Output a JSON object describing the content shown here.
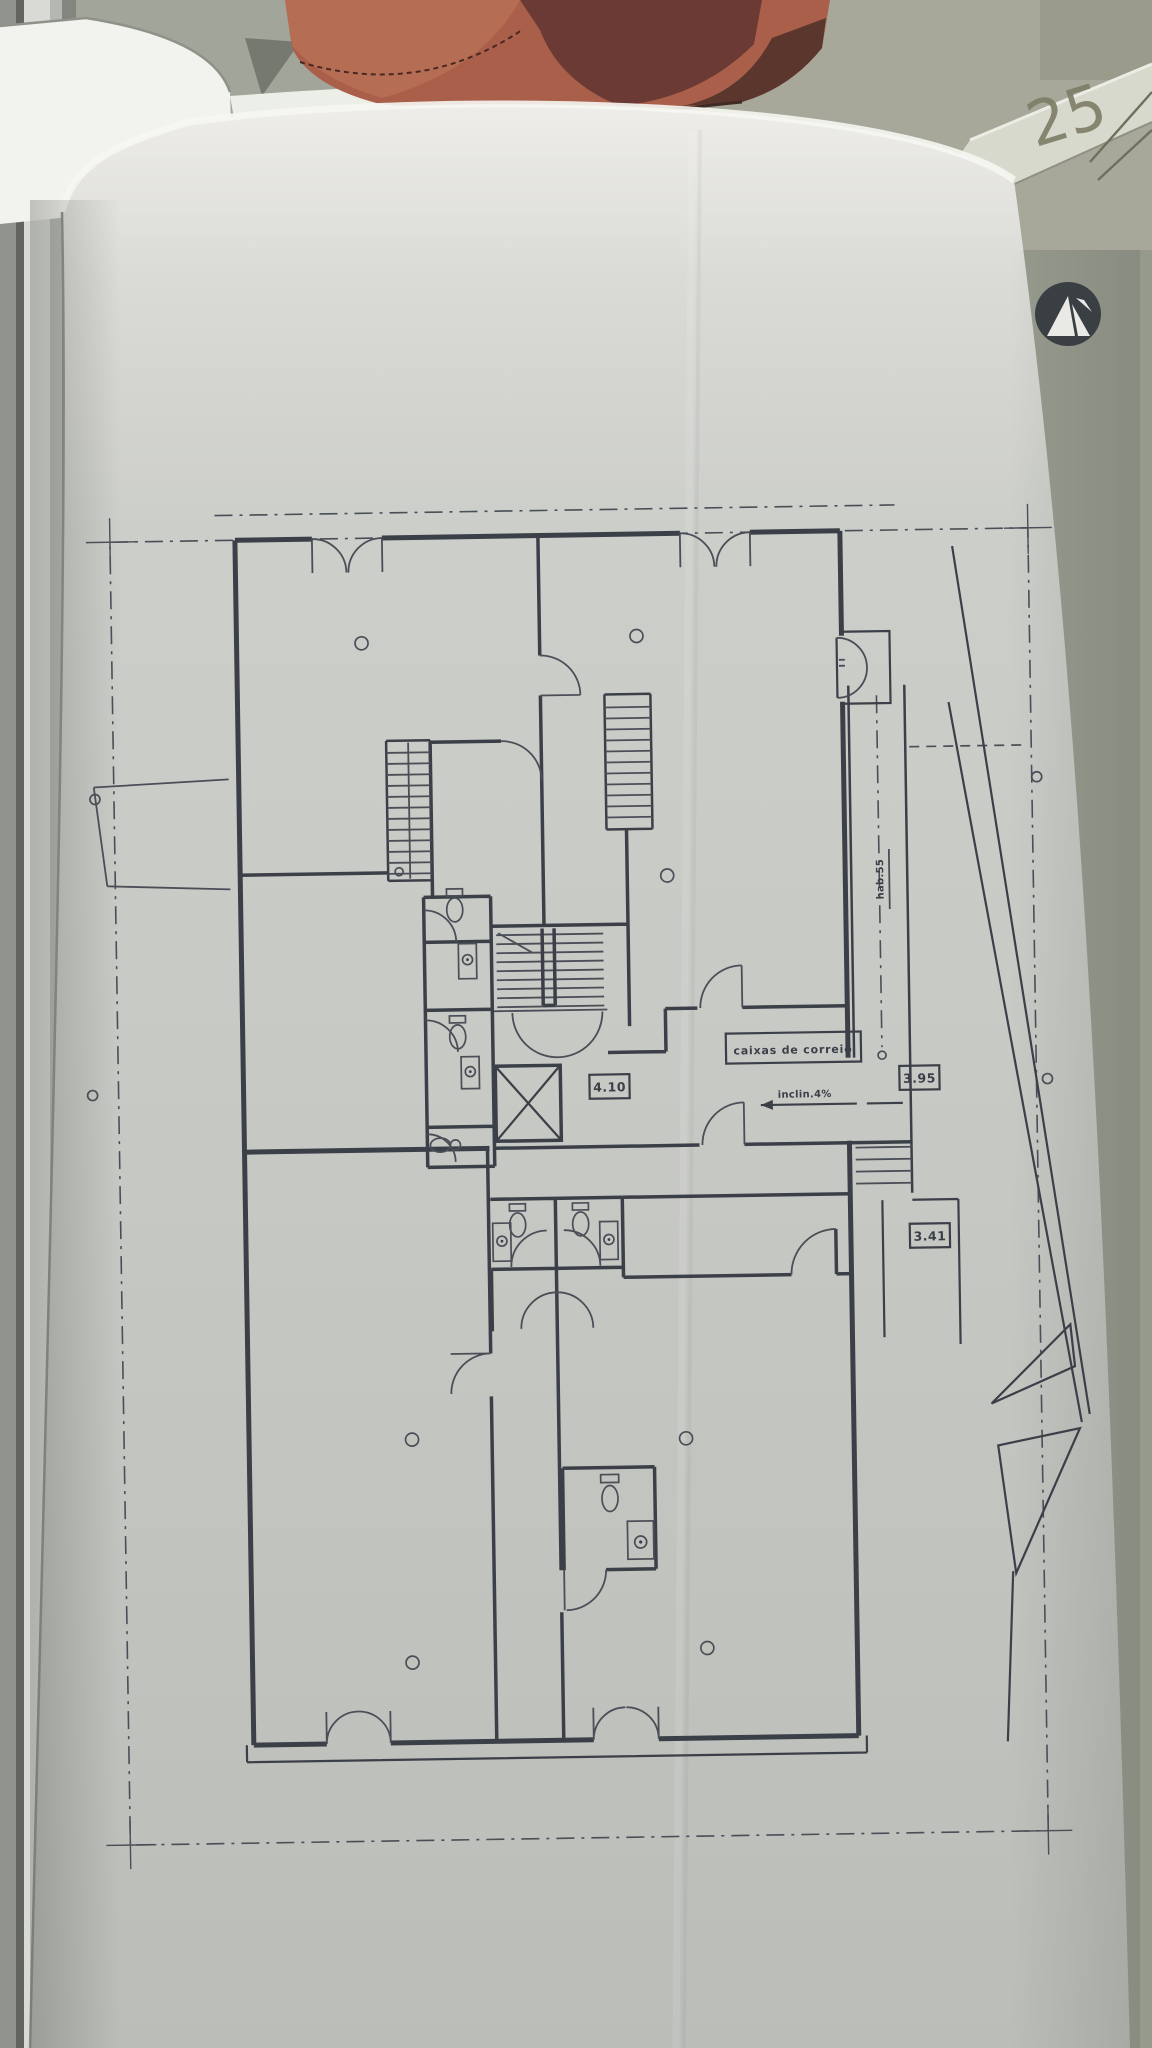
{
  "photo": {
    "handwritten_number": "25"
  },
  "plan": {
    "annotations": {
      "mailboxes_label": "caixas de correio",
      "hall_width": "4.10",
      "walkway_width": "3.95",
      "lower_walkway_width": "3.41",
      "ramp_slope_note": "inclin.4%",
      "walkway_axis_note": "hab.55"
    }
  },
  "icons": {
    "logo": "architect-monogram-icon",
    "fixtures": [
      "toilet-icon",
      "sink-icon",
      "elevator-x-icon",
      "stair-treads",
      "column-marker"
    ]
  },
  "colors": {
    "ink": "#3b4048",
    "ink_thin": "#4a4f57",
    "paper": "#c9cbc7",
    "leather": "#a95f49",
    "leather_dark": "#6b3a34",
    "side_paper": "#a7a89a",
    "pencil": "#7d7d66",
    "logo": "#3a3f43"
  }
}
